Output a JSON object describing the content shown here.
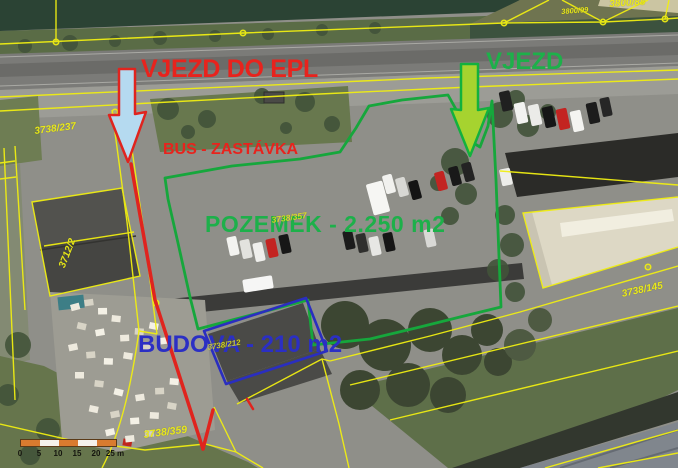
{
  "title": "Aerial cadastral map with site annotations",
  "annotations": {
    "entrance_epl_label": "VJEZD DO EPL",
    "entrance_label": "VJEZD",
    "bus_stop_label": "BUS - ZASTÁVKA",
    "land_label": "POZEMEK - 2.250 m2",
    "building_label": "BUDOVA - 210 m2"
  },
  "parcel_labels": [
    {
      "text": "3738/237",
      "x": 34,
      "y": 127,
      "rot": -7,
      "size": 10,
      "opacity": 0.95
    },
    {
      "text": "3712/2",
      "x": 58,
      "y": 266,
      "rot": -69,
      "size": 10,
      "opacity": 0.95
    },
    {
      "text": "3800/99",
      "x": 561,
      "y": 8,
      "rot": -4,
      "size": 7.5,
      "opacity": 0.95
    },
    {
      "text": "3800/88",
      "x": 609,
      "y": 0,
      "rot": -4,
      "size": 10,
      "opacity": 0.95
    },
    {
      "text": "3738/145",
      "x": 621,
      "y": 290,
      "rot": -12,
      "size": 10,
      "opacity": 0.95
    },
    {
      "text": "3738/359",
      "x": 143,
      "y": 430,
      "rot": -7,
      "size": 10.5,
      "opacity": 0.95
    },
    {
      "text": "3738/357",
      "x": 271,
      "y": 216,
      "rot": -8,
      "size": 8.5,
      "opacity": 0.8
    },
    {
      "text": "3738/212",
      "x": 207,
      "y": 344,
      "rot": -9,
      "size": 8,
      "opacity": 0.8
    }
  ],
  "scale_bar": {
    "segments": 5,
    "tick_labels": [
      "0",
      "5",
      "10",
      "15",
      "20",
      "25 m"
    ]
  },
  "colors": {
    "red_annotation": "#e8231d",
    "green_annotation": "#1db04a",
    "blue_annotation": "#2b2fc4",
    "cadastral_yellow": "#f0ee12",
    "arrow_fill_blue": "#b5daf0",
    "arrow_fill_green": "#a6d32f",
    "green_boundary": "#16a73c",
    "blue_outline": "#2a2ec0",
    "scale_orange": "#d97b2f"
  }
}
